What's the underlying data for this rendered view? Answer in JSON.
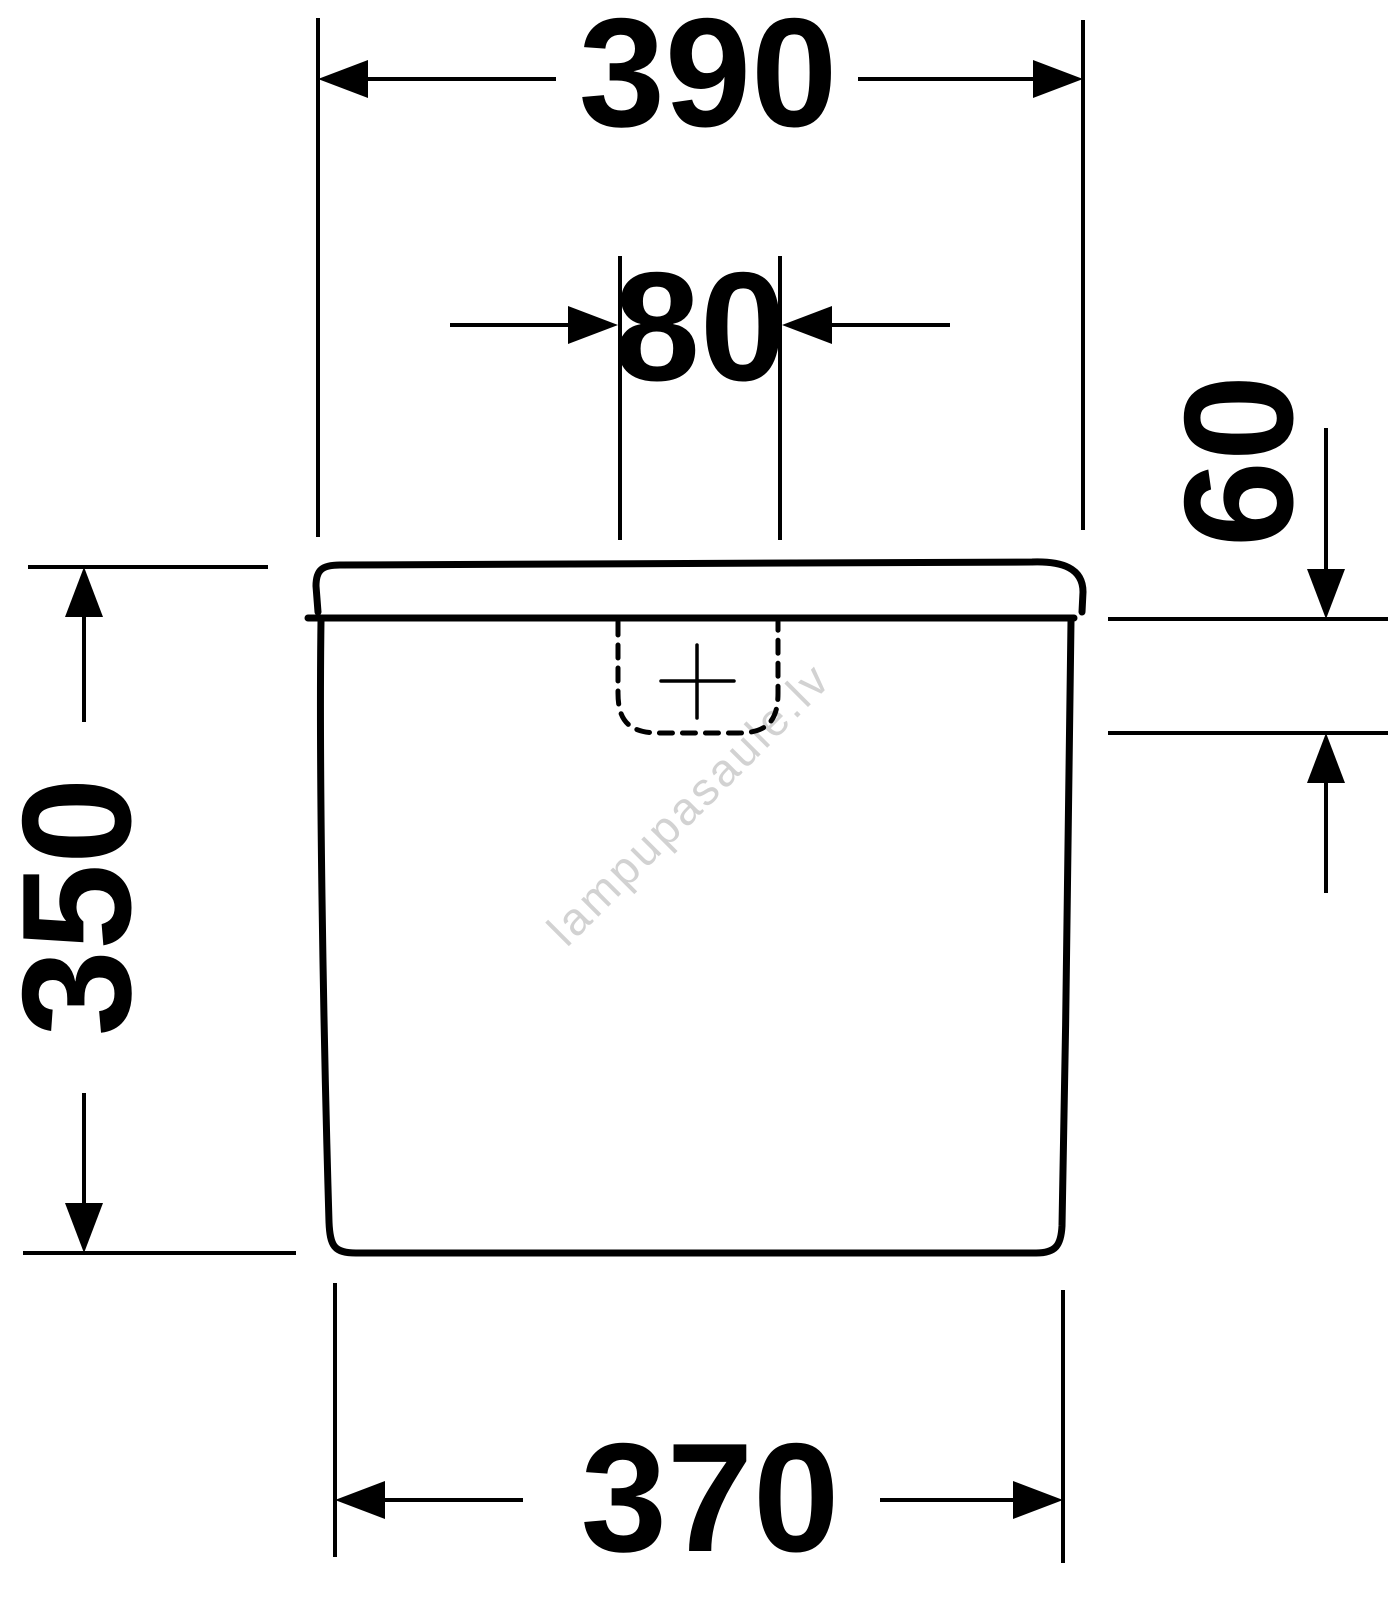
{
  "drawing": {
    "type": "technical-dimension-drawing",
    "units_implied": "mm",
    "line_color": "#000000",
    "background_color": "#ffffff",
    "dimensions": {
      "top_width": "390",
      "flush_button_width": "80",
      "lid_depth_right": "60",
      "overall_height": "350",
      "bottom_width": "370"
    },
    "watermark": {
      "text": "lampupasaule.lv",
      "color": "#d2d2d2"
    }
  }
}
